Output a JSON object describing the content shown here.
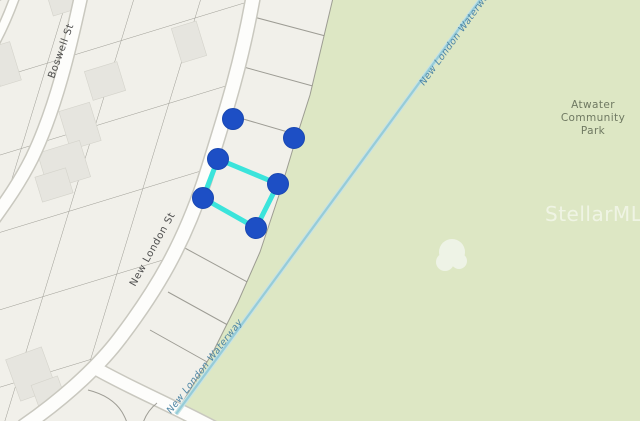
{
  "map": {
    "streets": {
      "boswell": "Boswell St",
      "new_london": "New London St"
    },
    "waterway": {
      "label_upper": "New London Waterway",
      "label_lower": "New London Waterway"
    },
    "park": {
      "line1": "Atwater",
      "line2": "Community",
      "line3": "Park"
    },
    "watermark": "StellarMLS",
    "selection": {
      "outline_vertices": [
        [
          218,
          159
        ],
        [
          278,
          184
        ],
        [
          256,
          228
        ],
        [
          203,
          198
        ]
      ],
      "markers": [
        [
          233,
          119
        ],
        [
          294,
          138
        ],
        [
          218,
          159
        ],
        [
          278,
          184
        ],
        [
          203,
          198
        ],
        [
          256,
          228
        ]
      ],
      "marker_radius": 10.5
    },
    "colors": {
      "base": "#f1f0ea",
      "park_fill": "#dde7c4",
      "road_fill": "#fdfdfb",
      "road_casing": "#c6c5bc",
      "parcel_line": "#8f8e86",
      "building": "#e6e5df",
      "waterway_line": "#96ccd8",
      "waterway_label": "#4e86a5",
      "street_label": "#4e4e4e",
      "park_label": "#6f7962",
      "marker": "#1d4fc5",
      "highlight": "#3be4db"
    }
  }
}
